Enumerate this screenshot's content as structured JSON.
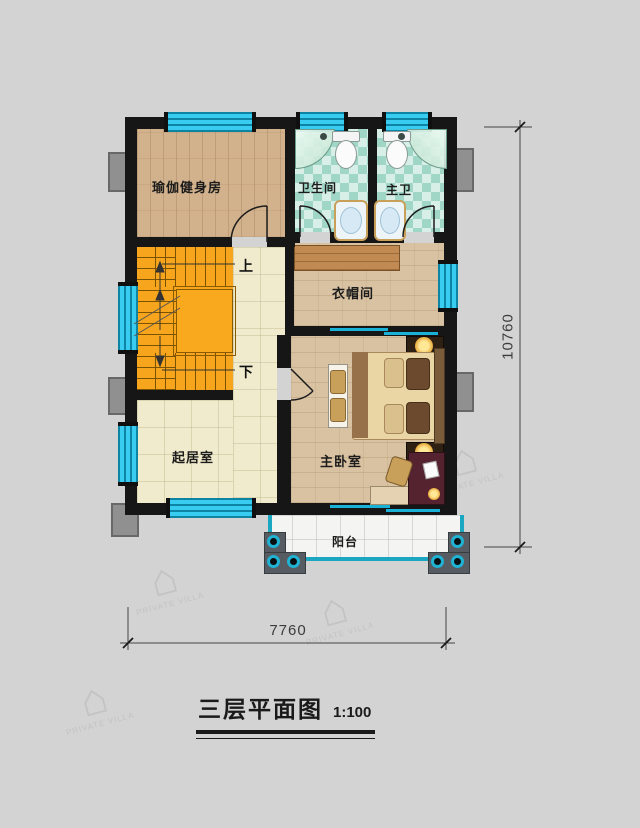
{
  "title": {
    "text": "三层平面图",
    "scale": "1:100"
  },
  "dimensions": {
    "bottom_width": "7760",
    "right_height": "10760"
  },
  "rooms": {
    "yoga": "瑜伽健身房",
    "bathroom": "卫生间",
    "master_bath": "主卫",
    "cloakroom": "衣帽间",
    "living": "起居室",
    "master_bedroom": "主卧室",
    "balcony": "阳台"
  },
  "stairs": {
    "up": "上",
    "down": "下"
  },
  "watermark": {
    "glyph": "⌂",
    "label": "PRIVATE VILLA"
  },
  "colors": {
    "wall": "#161616",
    "window": "#38cdf0",
    "stairs": "#f6a51c",
    "tile_cream": "#f1ebcd",
    "tile_teal": "#9fd6c6",
    "wood": "#d2b28c",
    "railing": "#1ba6c2",
    "background": "#d3d3d3"
  }
}
